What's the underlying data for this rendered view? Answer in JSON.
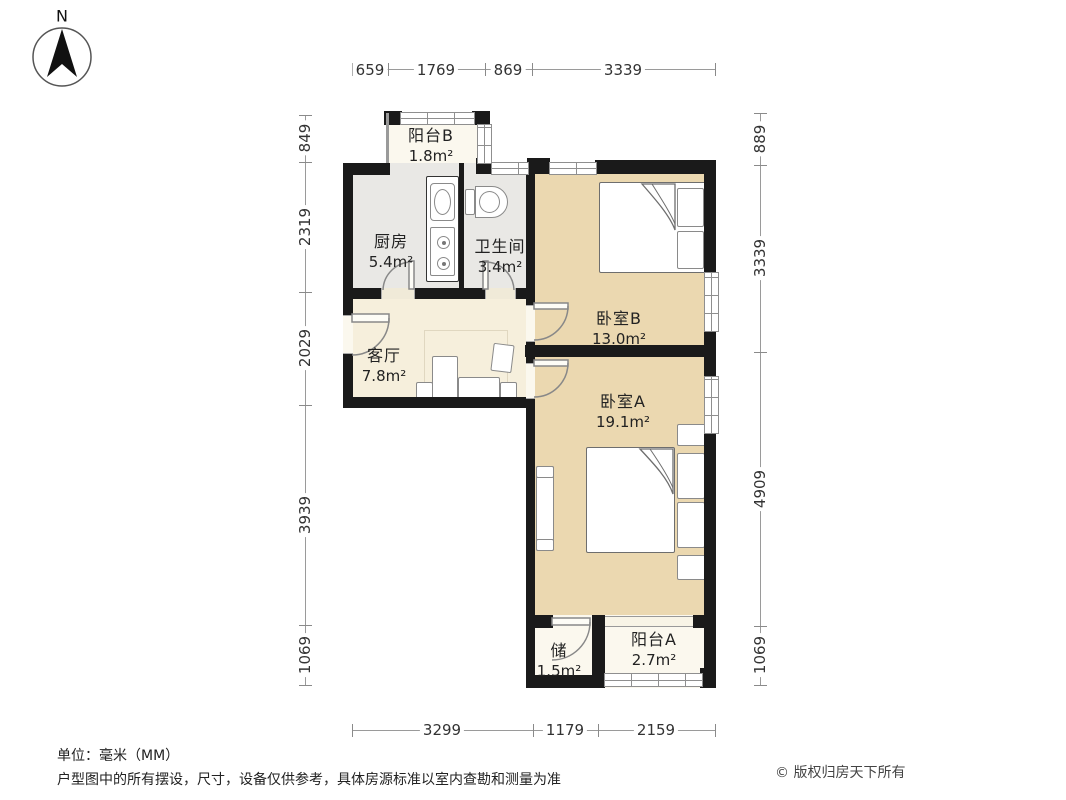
{
  "compass": {
    "north_label": "N"
  },
  "dimensions": {
    "top": [
      "659",
      "1769",
      "869",
      "3339"
    ],
    "bottom": [
      "3299",
      "1179",
      "2159"
    ],
    "left": [
      "849",
      "2319",
      "2029",
      "3939",
      "1069"
    ],
    "right": [
      "889",
      "3339",
      "4909",
      "1069"
    ]
  },
  "rooms": [
    {
      "id": "balcony-b",
      "name": "阳台B",
      "area": "1.8m²"
    },
    {
      "id": "kitchen",
      "name": "厨房",
      "area": "5.4m²"
    },
    {
      "id": "bathroom",
      "name": "卫生间",
      "area": "3.4m²"
    },
    {
      "id": "bedroom-b",
      "name": "卧室B",
      "area": "13.0m²"
    },
    {
      "id": "living-room",
      "name": "客厅",
      "area": "7.8m²"
    },
    {
      "id": "bedroom-a",
      "name": "卧室A",
      "area": "19.1m²"
    },
    {
      "id": "storage",
      "name": "储",
      "area": "1.5m²"
    },
    {
      "id": "balcony-a",
      "name": "阳台A",
      "area": "2.7m²"
    }
  ],
  "footer": {
    "unit": "单位：毫米（MM）",
    "disclaimer": "户型图中的所有摆设，尺寸，设备仅供参考，具体房源标准以室内查勘和测量为准",
    "copyright": "© 版权归房天下所有"
  },
  "colors": {
    "wall": "#1a1a1a",
    "bedroom_floor": "#ebd8b0",
    "living_floor": "#f6efdc",
    "balcony_floor": "#fbf8ee",
    "wet_floor": "#e9e8e5",
    "dim_text": "#333333",
    "line": "#9a9a9a"
  }
}
